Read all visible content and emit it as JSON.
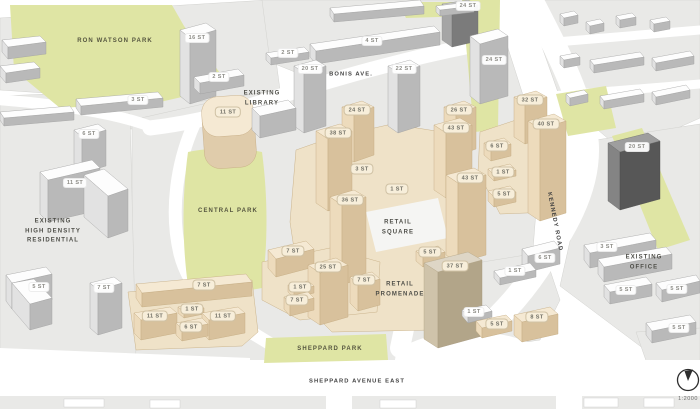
{
  "map": {
    "title": "development massing site plan",
    "scale_label": "1:2000",
    "compass": "north-arrow",
    "colors": {
      "proposed_building": "#f5e9d3",
      "existing_building": "#ffffff",
      "park_green": "#dfe5a4",
      "block_gray": "#e9e9e7",
      "road_white": "#ffffff"
    },
    "areas": {
      "ron_watson_park": "RON WATSON PARK",
      "existing_library": "EXISTING\nLIBRARY",
      "bonis_ave": "BONIS AVE.",
      "central_park": "CENTRAL PARK",
      "existing_high_density_residential": "EXISTING\nHIGH DENSITY\nRESIDENTIAL",
      "retail_square": "RETAIL\nSQUARE",
      "retail_promenade": "RETAIL\nPROMENADE",
      "kennedy_road": "KENNEDY ROAD",
      "existing_office": "EXISTING\nOFFICE",
      "sheppard_park": "SHEPPARD PARK",
      "sheppard_avenue_east": "SHEPPARD AVENUE EAST"
    },
    "proposed_buildings": [
      {
        "label": "11 ST"
      },
      {
        "label": "24 ST"
      },
      {
        "label": "26 ST"
      },
      {
        "label": "32 ST"
      },
      {
        "label": "38 ST"
      },
      {
        "label": "43 ST"
      },
      {
        "label": "40 ST"
      },
      {
        "label": "6 ST"
      },
      {
        "label": "3 ST"
      },
      {
        "label": "1 ST"
      },
      {
        "label": "43 ST"
      },
      {
        "label": "1 ST"
      },
      {
        "label": "5 ST"
      },
      {
        "label": "36 ST"
      },
      {
        "label": "5 ST"
      },
      {
        "label": "7 ST"
      },
      {
        "label": "37 ST"
      },
      {
        "label": "25 ST"
      },
      {
        "label": "7 ST"
      },
      {
        "label": "1 ST"
      },
      {
        "label": "7 ST"
      },
      {
        "label": "7 ST"
      },
      {
        "label": "1 ST"
      },
      {
        "label": "11 ST"
      },
      {
        "label": "11 ST"
      },
      {
        "label": "6 ST"
      },
      {
        "label": "8 ST"
      },
      {
        "label": "5 ST"
      }
    ],
    "existing_buildings": [
      {
        "label": "24 ST"
      },
      {
        "label": "16 ST"
      },
      {
        "label": "4 ST"
      },
      {
        "label": "2 ST"
      },
      {
        "label": "24 ST"
      },
      {
        "label": "20 ST"
      },
      {
        "label": "22 ST"
      },
      {
        "label": "2 ST"
      },
      {
        "label": "3 ST"
      },
      {
        "label": "6 ST"
      },
      {
        "label": "20 ST"
      },
      {
        "label": "11 ST"
      },
      {
        "label": "3 ST"
      },
      {
        "label": "6 ST"
      },
      {
        "label": "1 ST"
      },
      {
        "label": "5 ST"
      },
      {
        "label": "7 ST"
      },
      {
        "label": "5 ST"
      },
      {
        "label": "5 ST"
      },
      {
        "label": "1 ST"
      },
      {
        "label": "5 ST"
      }
    ]
  }
}
